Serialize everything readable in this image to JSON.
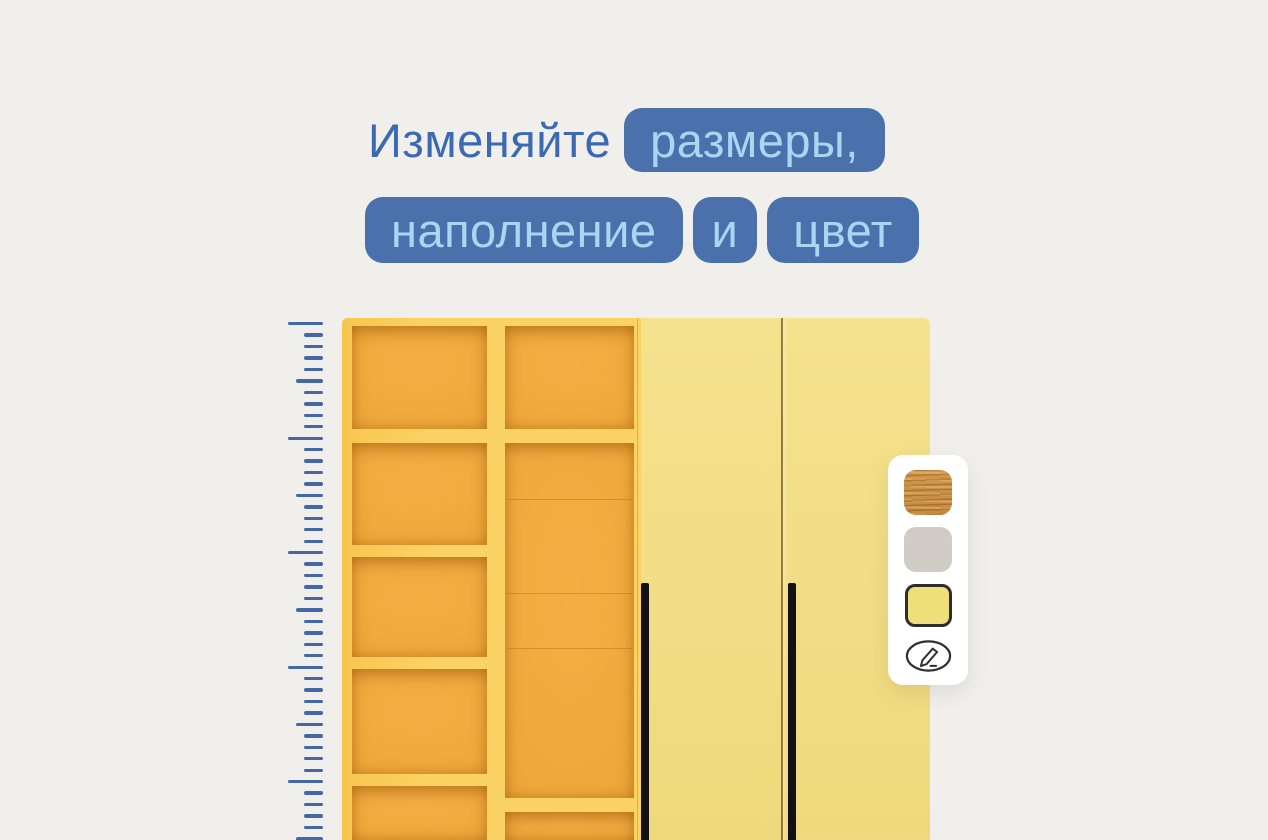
{
  "headline": {
    "line1_plain": "Изменяйте",
    "line1_badge": "размеры,",
    "line2_badges": [
      "наполнение",
      "и",
      "цвет"
    ]
  },
  "colors": {
    "background": "#f0efec",
    "headline_text": "#3c6ab2",
    "badge_bg": "#4a71ac",
    "badge_text": "#a9d7f2",
    "ruler_tick": "#4467a6",
    "shelf_frame": "#fbd364",
    "shelf_interior": "#f3ae43",
    "door": "#f2dd85",
    "handle": "#141210",
    "panel_bg": "#ffffff",
    "swatch_selected_border": "#2d2d2d",
    "icon_stroke": "#2f2f2f"
  },
  "ruler": {
    "tick_count": 46,
    "spacing_px": 11.45,
    "long_every": 10,
    "medium_every": 5
  },
  "palette": {
    "swatches": [
      {
        "name": "oak-wood-swatch",
        "type": "wood",
        "color": "#c68a3f",
        "selected": false,
        "top": 15
      },
      {
        "name": "gray-swatch",
        "type": "color",
        "color": "#d2ccc7",
        "selected": false,
        "top": 72
      },
      {
        "name": "yellow-swatch",
        "type": "color",
        "color": "#efdf78",
        "selected": true,
        "top": 129
      }
    ],
    "edit_icon": "pencil-icon"
  }
}
